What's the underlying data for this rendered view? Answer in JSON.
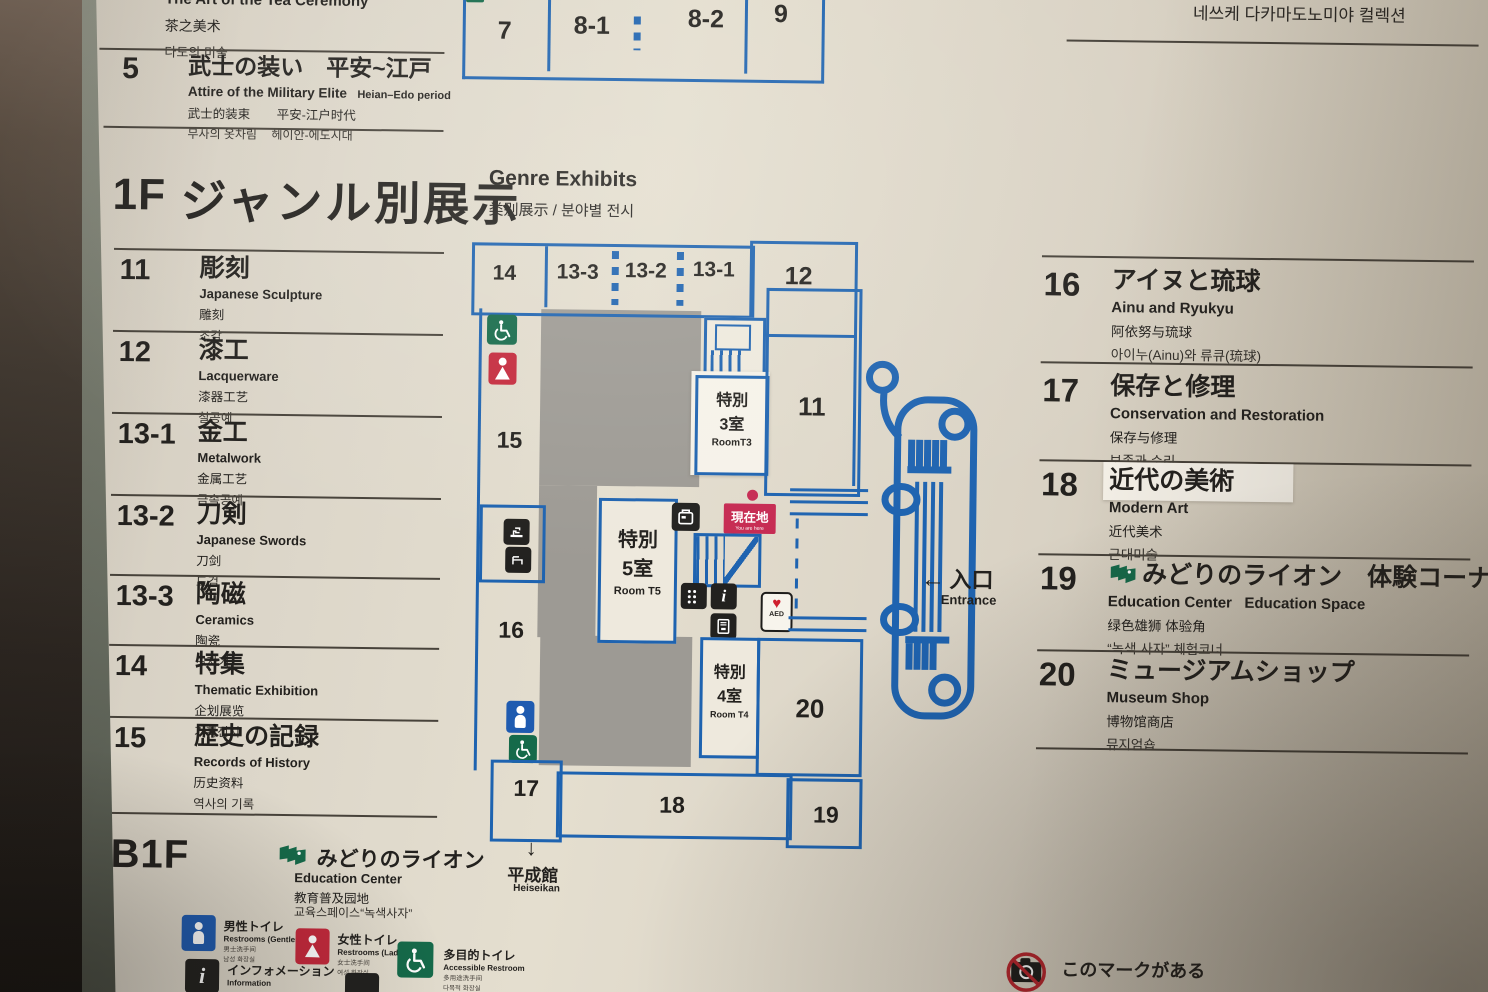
{
  "panel": {
    "colors": {
      "map_blue": "#1e63b0",
      "courtyard_gray": "#9d9a94",
      "you_are_here_red": "#c62a52",
      "icon_green": "#156a4a",
      "icon_red": "#c4293c",
      "icon_blue": "#1f5bb0",
      "panel_beige": "#dcd6c9"
    },
    "top_entries": {
      "tea": {
        "en": "The Art of the Tea Ceremony",
        "zh": "茶之美术",
        "ko": "다도의 미술"
      },
      "room5": {
        "num": "5",
        "ja": "武士の装い　平安~江戸",
        "en": "Attire of the Military Elite",
        "period_en": "Heian–Edo period",
        "zh": "武士的装束",
        "period_zh": "平安-江户时代",
        "ko": "무사의 옷차림",
        "period_ko": "헤이안-에도시대"
      }
    },
    "floor1": {
      "floor": "1F",
      "title_ja": "ジャンル別展示",
      "title_en": "Genre Exhibits",
      "subtitle": "类别展示 / 분야별 전시"
    },
    "left_list": [
      {
        "num": "11",
        "ja": "彫刻",
        "en": "Japanese Sculpture",
        "zh": "雕刻",
        "ko": "조각"
      },
      {
        "num": "12",
        "ja": "漆工",
        "en": "Lacquerware",
        "zh": "漆器工艺",
        "ko": "칠공예"
      },
      {
        "num": "13-1",
        "ja": "金工",
        "en": "Metalwork",
        "zh": "金属工艺",
        "ko": "금속공예"
      },
      {
        "num": "13-2",
        "ja": "刀剣",
        "en": "Japanese Swords",
        "zh": "刀剑",
        "ko": "도검"
      },
      {
        "num": "13-3",
        "ja": "陶磁",
        "en": "Ceramics",
        "zh": "陶瓷",
        "ko": "도자기"
      },
      {
        "num": "14",
        "ja": "特集",
        "en": "Thematic Exhibition",
        "zh": "企划展览",
        "ko": "기획전시"
      },
      {
        "num": "15",
        "ja": "歴史の記録",
        "en": "Records of History",
        "zh": "历史资料",
        "ko": "역사의 기록"
      }
    ],
    "b1f": {
      "floor": "B1F",
      "ja": "みどりのライオン",
      "en": "Education Center",
      "zh": "教育普及园地",
      "ko": "교육스페이스“녹색사자”"
    },
    "legend": [
      {
        "ja": "男性トイレ",
        "en": "Restrooms (Gentlemen)",
        "zh": "男士洗手间",
        "ko": "남성 화장실"
      },
      {
        "ja": "女性トイレ",
        "en": "Restrooms (Ladies)",
        "zh": "女士洗手间",
        "ko": "여성 화장실"
      },
      {
        "ja": "多目的トイレ",
        "en": "Accessible Restroom",
        "zh": "多用途洗手间",
        "ko": "다목적 화장실"
      },
      {
        "ja": "インフォメーション",
        "en": "Information",
        "zh": "问讯处",
        "ko": "안내"
      }
    ],
    "right_list": [
      {
        "num": "16",
        "ja": "アイヌと琉球",
        "en": "Ainu and Ryukyu",
        "zh": "阿依努与琉球",
        "ko": "아이누(Ainu)와 류큐(琉球)"
      },
      {
        "num": "17",
        "ja": "保存と修理",
        "en": "Conservation and Restoration",
        "zh": "保存与修理",
        "ko": "보존과 수리"
      },
      {
        "num": "18",
        "ja": "近代の美術",
        "en": "Modern Art",
        "zh": "近代美术",
        "ko": "근대미술"
      },
      {
        "num": "19",
        "ja": "みどりのライオン　体験コーナー",
        "en": "Education Center   Education Space",
        "zh": "绿色雄狮 体验角",
        "ko": "“녹색 사자” 체험코너"
      },
      {
        "num": "20",
        "ja": "ミュージアムショップ",
        "en": "Museum Shop",
        "zh": "博物馆商店",
        "ko": "뮤지엄숍"
      }
    ],
    "top_right_partial": "네쓰케 다카마도노미야 컬렉션",
    "no_photo_note": "このマークがある",
    "map": {
      "top_rooms": {
        "r7": "7",
        "r81": "8-1",
        "r82": "8-2",
        "r9": "9"
      },
      "rooms": {
        "r14": "14",
        "r133": "13-3",
        "r132": "13-2",
        "r131": "13-1",
        "r12": "12",
        "r11": "11",
        "r15": "15",
        "r16": "16",
        "r17": "17",
        "r18": "18",
        "r19": "19",
        "r20": "20"
      },
      "roomT3": {
        "l1": "特別",
        "l2": "3室",
        "l3": "RoomT3"
      },
      "roomT5": {
        "l1": "特別",
        "l2": "5室",
        "l3": "Room T5"
      },
      "roomT4": {
        "l1": "特別",
        "l2": "4室",
        "l3": "Room T4"
      },
      "you_are_here": {
        "ja": "現在地",
        "en": "You are here"
      },
      "entrance": {
        "arrow": "←",
        "ja": "入口",
        "en": "Entrance"
      },
      "heiseikan": {
        "arrow": "↓",
        "ja": "平成館",
        "en": "Heiseikan"
      },
      "aed_label": "AED"
    }
  }
}
